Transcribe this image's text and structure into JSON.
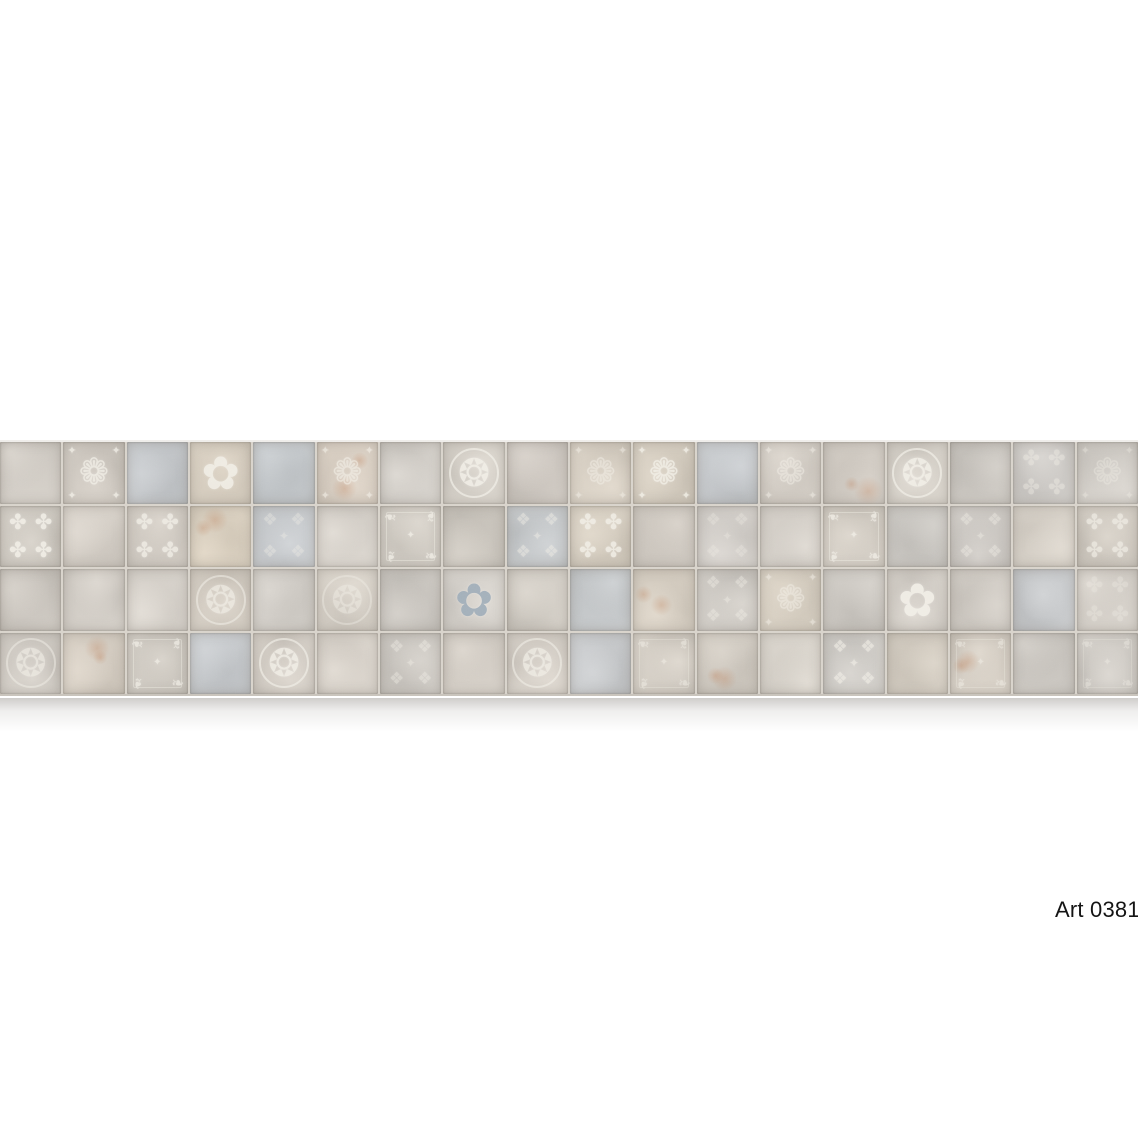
{
  "page": {
    "background": "#ffffff"
  },
  "label": {
    "text": "Art 0381",
    "bg": "#ffffff",
    "color": "#141414"
  },
  "panel": {
    "rows": 4,
    "cols": 18,
    "grout_color": "#d8d3cb",
    "top_bevel_color": "#efedea",
    "bottom_edge_color": "#c8c3bb",
    "shadow_color": "rgba(96,90,82,0.30)",
    "ornament_color": "#f3f0e8",
    "rust_color": "rgba(187,124,84,0.30)"
  },
  "motifs": {
    "medallion": "❂",
    "damask": "❁",
    "fleur": "✿",
    "quatrefoil": "✤",
    "lattice": "❖",
    "frame": "❧",
    "accent": "✦"
  },
  "tiles": [
    {
      "c": "#d2cdc6"
    },
    {
      "c": "#cfc9c1",
      "m": "damask",
      "o": 0.75
    },
    {
      "c": "#c5c8cb"
    },
    {
      "c": "#d7cec0",
      "m": "fleur",
      "o": 0.85
    },
    {
      "c": "#c3c7ca"
    },
    {
      "c": "#d8cec2",
      "m": "damask",
      "o": 0.6,
      "rust": true
    },
    {
      "c": "#d3cfc9"
    },
    {
      "c": "#d6d1c9",
      "m": "medallion",
      "o": 0.85
    },
    {
      "c": "#cfc9c2"
    },
    {
      "c": "#d8d0c4",
      "m": "damask",
      "o": 0.5
    },
    {
      "c": "#d5cdc0",
      "m": "damask",
      "o": 0.8
    },
    {
      "c": "#c6c9cc"
    },
    {
      "c": "#d4cec6",
      "m": "damask",
      "o": 0.5
    },
    {
      "c": "#d0cac2",
      "rust": true
    },
    {
      "c": "#d7d2ca",
      "m": "medallion",
      "o": 0.85
    },
    {
      "c": "#cac6c0"
    },
    {
      "c": "#cfccc8",
      "m": "quatrefoil",
      "o": 0.4
    },
    {
      "c": "#d3cfc9",
      "m": "damask",
      "o": 0.35
    },
    {
      "c": "#d0cbc3",
      "m": "quatrefoil",
      "o": 0.85
    },
    {
      "c": "#d6d0c8"
    },
    {
      "c": "#d2ccc4",
      "m": "quatrefoil",
      "o": 0.75
    },
    {
      "c": "#d9cfbf",
      "rust": true
    },
    {
      "c": "#c8cbce",
      "m": "lattice",
      "o": 0.35
    },
    {
      "c": "#d8d3cc"
    },
    {
      "c": "#d2cdc5",
      "m": "frame",
      "o": 0.75
    },
    {
      "c": "#ccc7bf"
    },
    {
      "c": "#c6c9cb",
      "m": "lattice",
      "o": 0.45
    },
    {
      "c": "#d7cfc2",
      "m": "quatrefoil",
      "o": 0.8
    },
    {
      "c": "#cfc9c1"
    },
    {
      "c": "#d3cfca",
      "m": "lattice",
      "o": 0.3
    },
    {
      "c": "#d6d1ca"
    },
    {
      "c": "#d4cec5",
      "m": "frame",
      "o": 0.75
    },
    {
      "c": "#c9c6c1"
    },
    {
      "c": "#cdc9c4",
      "m": "lattice",
      "o": 0.4
    },
    {
      "c": "#d8d2c9"
    },
    {
      "c": "#d2ccc3",
      "m": "quatrefoil",
      "o": 0.65
    },
    {
      "c": "#cdc8c1"
    },
    {
      "c": "#d4cfc8"
    },
    {
      "c": "#d9d4cd"
    },
    {
      "c": "#d3ccc2",
      "m": "medallion",
      "o": 0.65
    },
    {
      "c": "#d0ccc6"
    },
    {
      "c": "#d6d0c7",
      "m": "medallion",
      "o": 0.45
    },
    {
      "c": "#cac6c0"
    },
    {
      "c": "#d5d1cb",
      "m": "fleur",
      "o": 0.9,
      "mc": "#9fadb9"
    },
    {
      "c": "#d2cdc5"
    },
    {
      "c": "#c5c8ca"
    },
    {
      "c": "#d7cfc3",
      "rust": true
    },
    {
      "c": "#cfcbc5",
      "m": "lattice",
      "o": 0.4
    },
    {
      "c": "#d6cec1",
      "m": "damask",
      "o": 0.5
    },
    {
      "c": "#ccc8c2"
    },
    {
      "c": "#d4cfc8",
      "m": "fleur",
      "o": 0.9
    },
    {
      "c": "#d0cbc4"
    },
    {
      "c": "#c8cacc"
    },
    {
      "c": "#d5d0c9",
      "m": "quatrefoil",
      "o": 0.3
    },
    {
      "c": "#d1ccc5",
      "m": "medallion",
      "o": 0.6
    },
    {
      "c": "#d7cfc4",
      "rust": true
    },
    {
      "c": "#cfcac2",
      "m": "frame",
      "o": 0.7
    },
    {
      "c": "#c6c9cc"
    },
    {
      "c": "#d4cec6",
      "m": "medallion",
      "o": 0.8
    },
    {
      "c": "#d8d2ca"
    },
    {
      "c": "#cdc9c3",
      "m": "lattice",
      "o": 0.4
    },
    {
      "c": "#d3cdc5"
    },
    {
      "c": "#d6d0c8",
      "m": "medallion",
      "o": 0.7
    },
    {
      "c": "#c9cbcd"
    },
    {
      "c": "#d5cfc6",
      "m": "frame",
      "o": 0.5
    },
    {
      "c": "#d0cac1",
      "rust": true
    },
    {
      "c": "#d8d3cb"
    },
    {
      "c": "#cfccc7",
      "m": "lattice",
      "o": 0.6
    },
    {
      "c": "#d3ccc1"
    },
    {
      "c": "#d6cfc5",
      "m": "frame",
      "o": 0.5,
      "rust": true
    },
    {
      "c": "#cbc7c1"
    },
    {
      "c": "#d2cec8",
      "m": "frame",
      "o": 0.4
    }
  ]
}
